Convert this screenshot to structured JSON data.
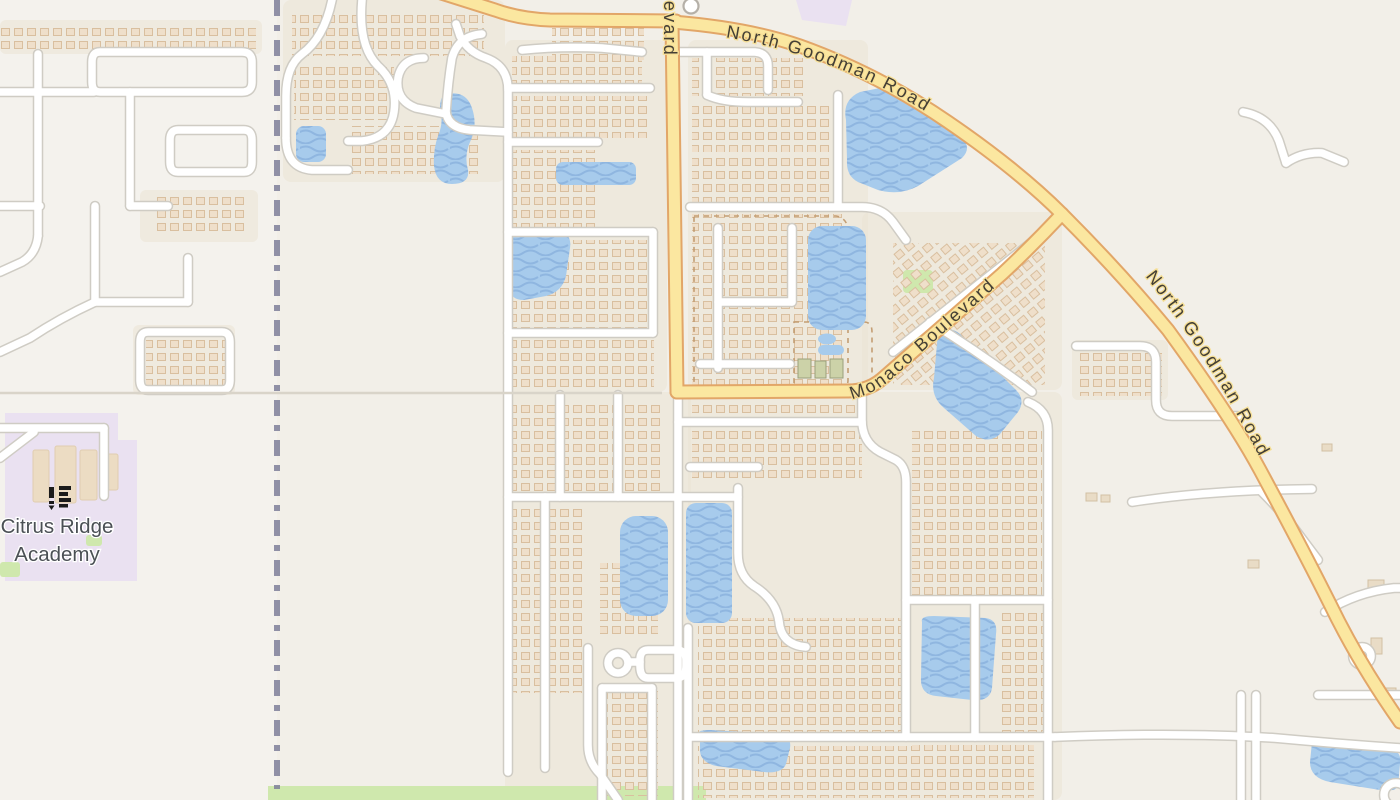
{
  "map": {
    "labels": {
      "road_main_1": "North Goodman Road",
      "road_main_2": "North Goodman Road",
      "road_monaco": "Monaco Boulevard",
      "road_vertical_partial": "Boulevard",
      "school_line1": "Citrus Ridge",
      "school_line2": "Academy"
    },
    "colors": {
      "land": "#f2efe8",
      "land_west": "#f5f3f0",
      "residential": "#ebe3d4",
      "school_area": "#eae1f1",
      "water": "#a7cbec",
      "water_wave": "#8fb6e0",
      "major_road_fill": "#fbe7a0",
      "major_road_casing": "#e2a668",
      "minor_road_fill": "#ffffff",
      "minor_road_casing": "#cfccc4",
      "boundary": "#7e7f99",
      "grass": "#cfe8ad",
      "house": "#efdfca",
      "road_label": "#443f35",
      "school_label": "#4b5055"
    },
    "icons": {
      "school": "school-icon",
      "poi": "poi-circle-icon"
    }
  }
}
